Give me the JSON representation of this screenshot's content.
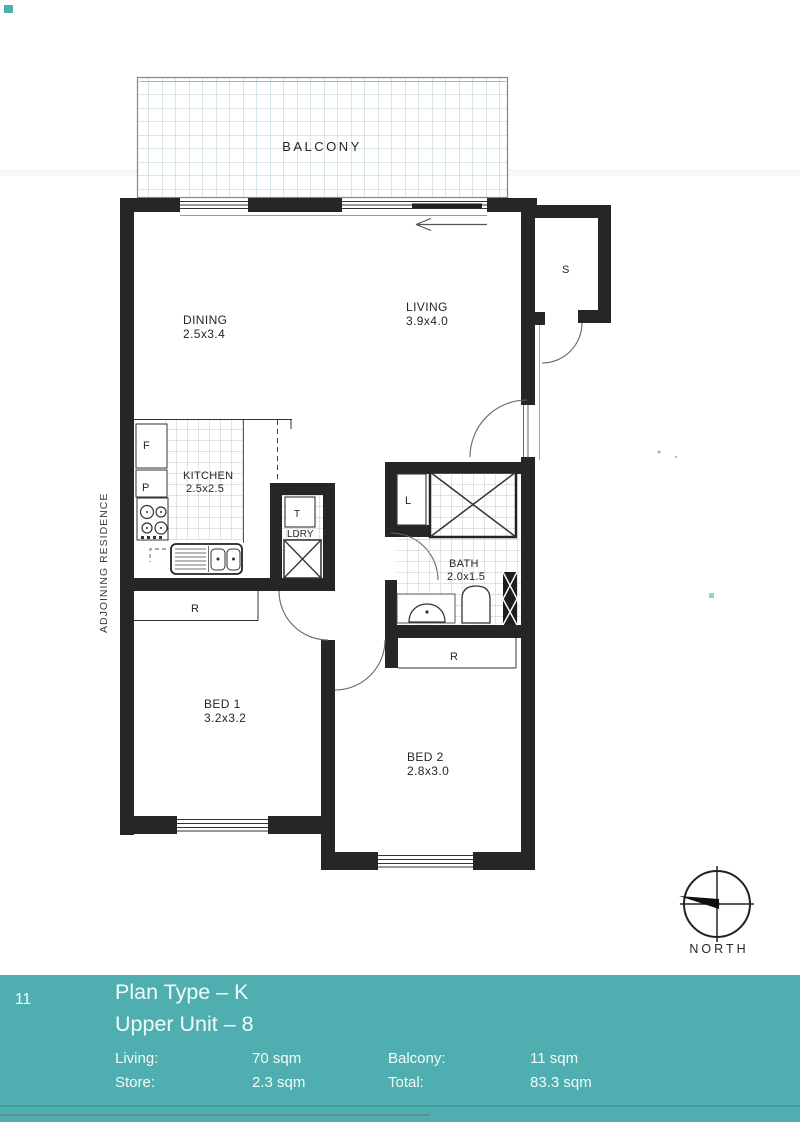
{
  "doc": {
    "page_number": "11",
    "plan_type": "Plan Type – K",
    "unit": "Upper Unit – 8",
    "areas": [
      {
        "label": "Living:",
        "value": "70 sqm"
      },
      {
        "label": "Store:",
        "value": "2.3 sqm"
      },
      {
        "label": "Balcony:",
        "value": "11 sqm"
      },
      {
        "label": "Total:",
        "value": "83.3 sqm"
      }
    ]
  },
  "plan": {
    "balcony": "BALCONY",
    "adjoining": "ADJOINING RESIDENCE",
    "north": "NORTH",
    "rooms": {
      "dining": {
        "name": "DINING",
        "dims": "2.5x3.4"
      },
      "living": {
        "name": "LIVING",
        "dims": "3.9x4.0"
      },
      "kitchen": {
        "name": "KITCHEN",
        "dims": "2.5x2.5"
      },
      "bath": {
        "name": "BATH",
        "dims": "2.0x1.5"
      },
      "bed1": {
        "name": "BED 1",
        "dims": "3.2x3.2"
      },
      "bed2": {
        "name": "BED 2",
        "dims": "2.8x3.0"
      }
    },
    "tags": {
      "store": "S",
      "fridge": "F",
      "pantry": "P",
      "tub": "T",
      "laundry": "LDRY",
      "linen": "L",
      "robe1": "R",
      "robe2": "R"
    }
  },
  "colors": {
    "band_teal": "#4fafb0",
    "wall_black": "#262626",
    "balcony_grid": "#b4ccd8",
    "tile_grid": "#b9c5ce"
  }
}
